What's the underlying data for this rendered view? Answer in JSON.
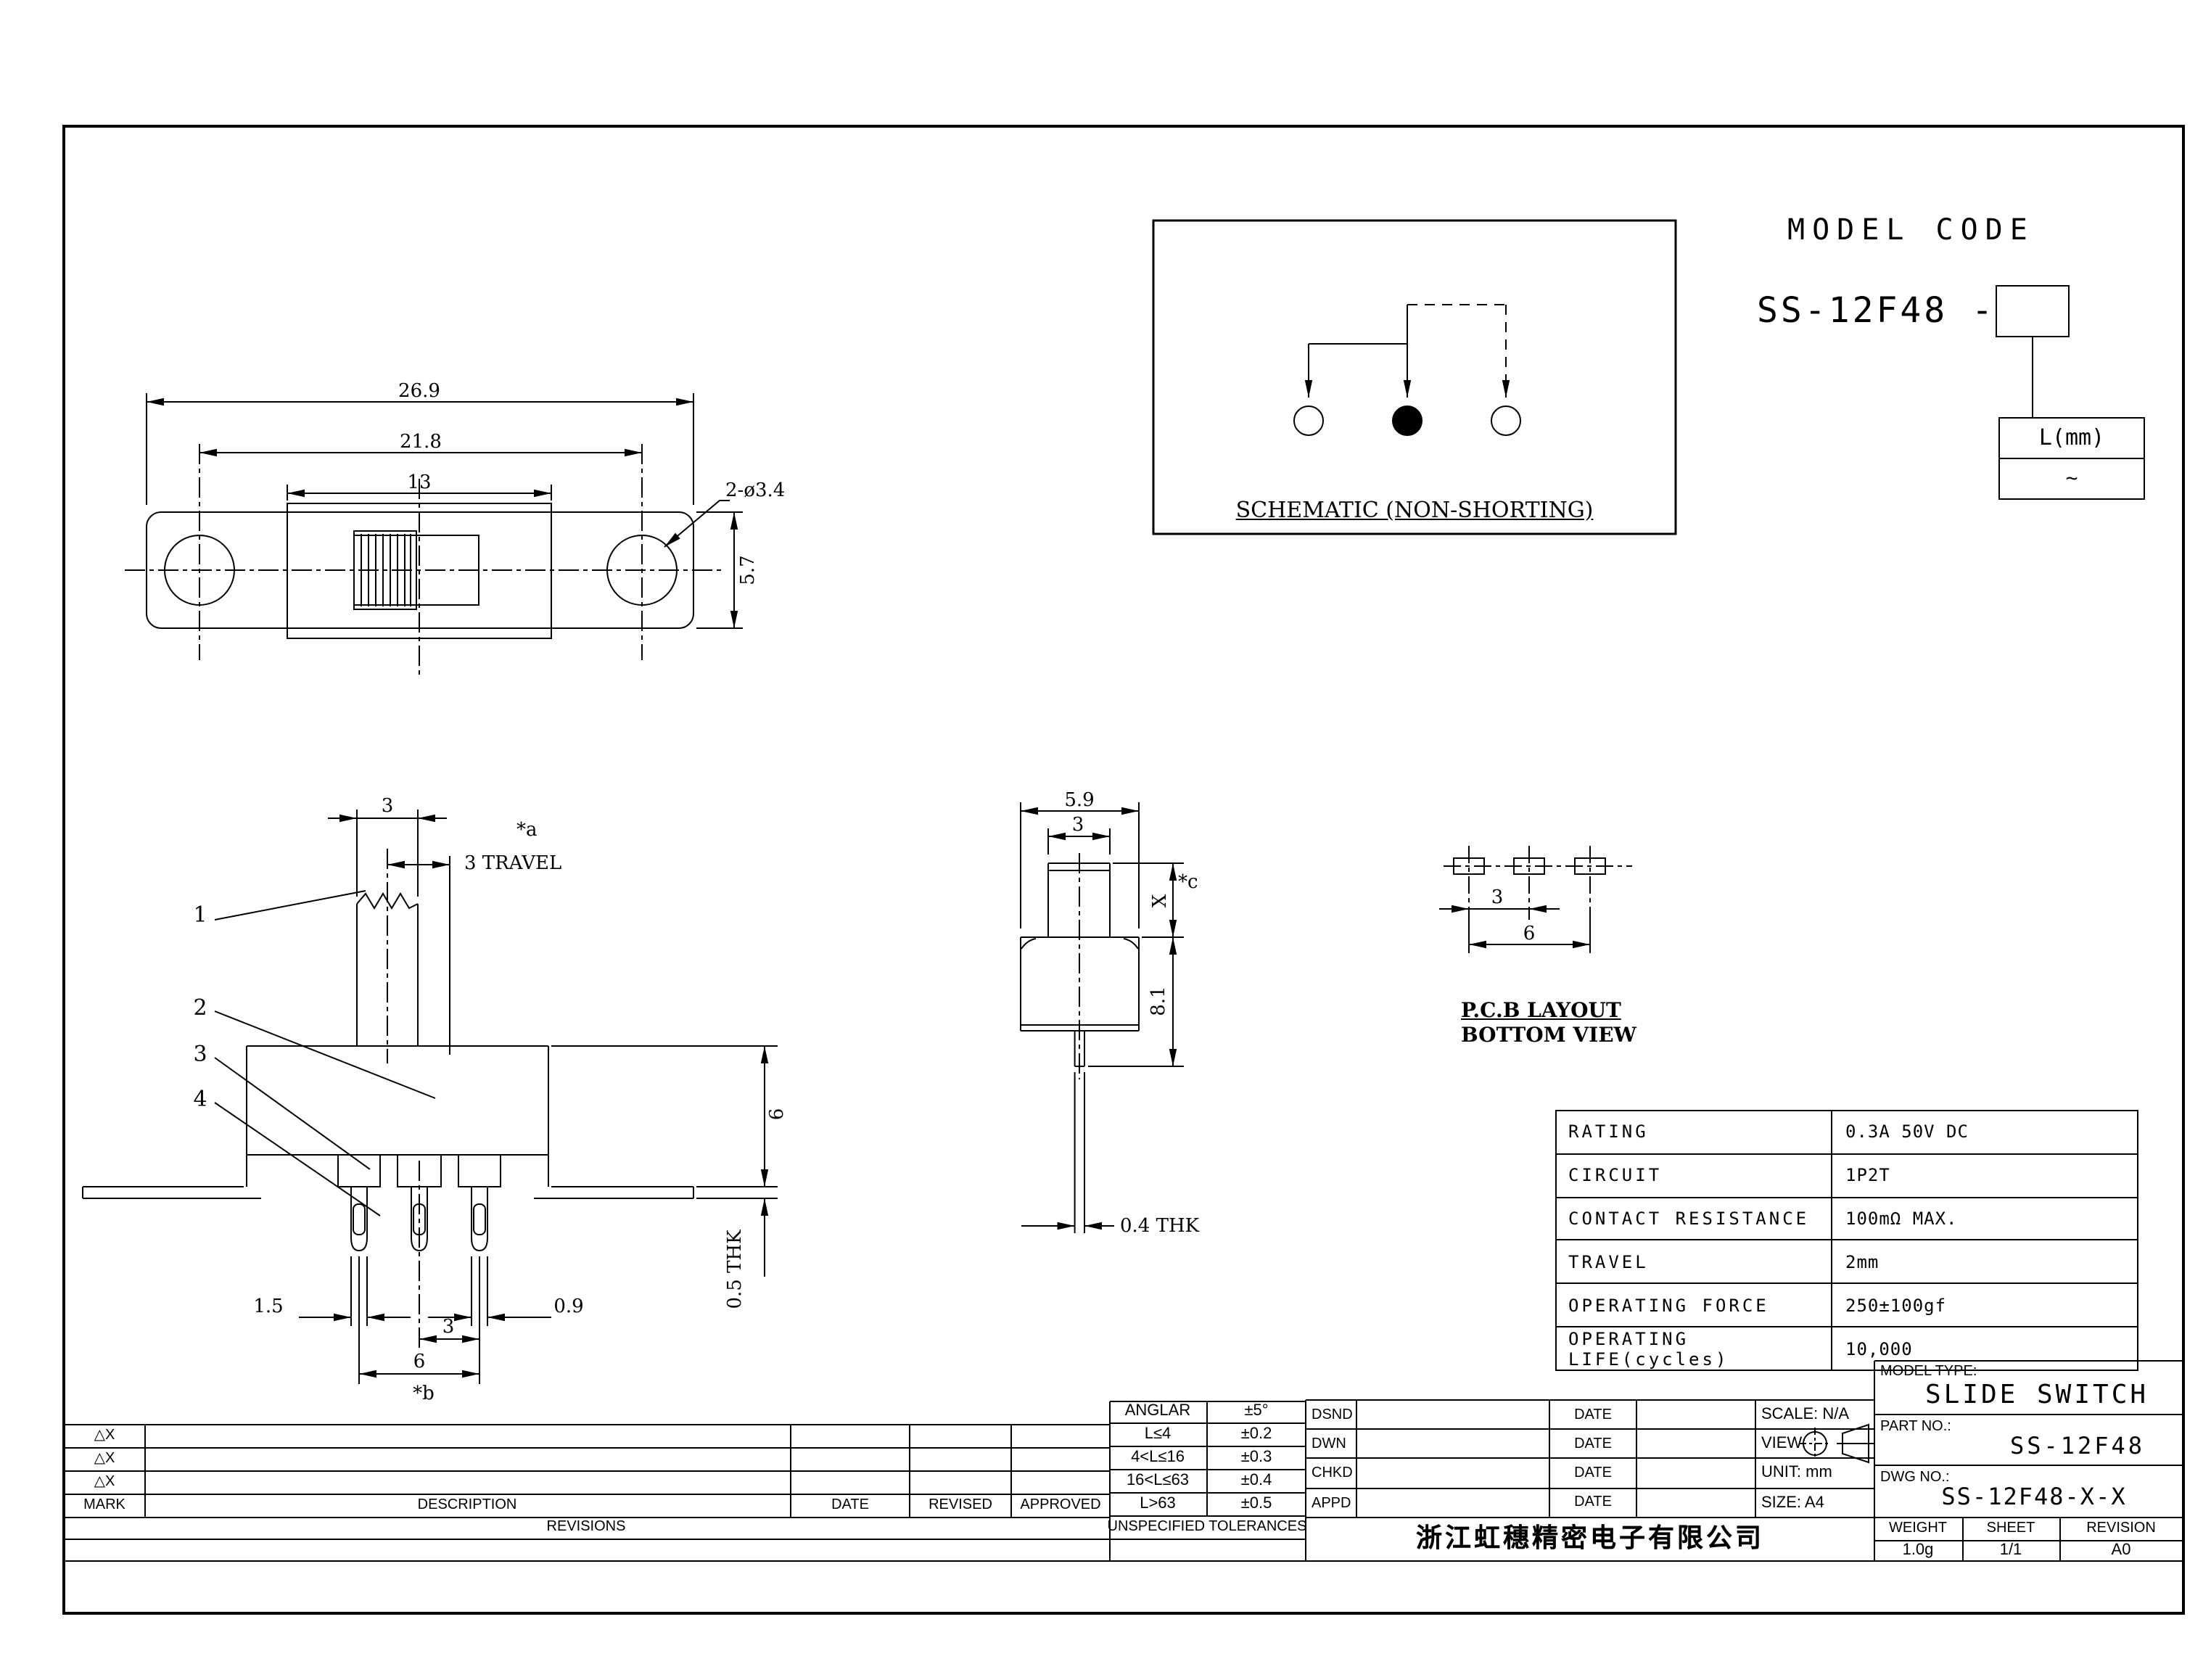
{
  "drawing": {
    "model_code": {
      "title": "MODEL CODE",
      "prefix": "SS-12F48 -",
      "suffix_header": "L(mm)",
      "suffix_value": "~"
    },
    "schematic": {
      "caption": "SCHEMATIC (NON-SHORTING)"
    },
    "plan_view": {
      "dim_overall": "26.9",
      "dim_hole_span": "21.8",
      "dim_frame": "13",
      "dim_holes": "2-ø3.4",
      "dim_height": "5.7"
    },
    "front_view": {
      "dim_knob": "3",
      "note_a": "*a",
      "dim_travel": "3 TRAVEL",
      "leader_1": "1",
      "leader_2": "2",
      "leader_3": "3",
      "leader_4": "4",
      "dim_body_height": "6",
      "dim_bracket_thk": "0.5 THK",
      "dim_pin_left": "1.5",
      "dim_pin_width": "0.9",
      "dim_pin_pitch": "3",
      "dim_pin_span": "6",
      "note_b": "*b"
    },
    "side_view": {
      "dim_width": "5.9",
      "dim_knob": "3",
      "dim_knob_height": "X",
      "note_c": "*c",
      "dim_body": "8.1",
      "dim_pin_thk": "0.4 THK"
    },
    "pcb_layout": {
      "title": "P.C.B LAYOUT",
      "subtitle": "BOTTOM VIEW",
      "dim_pitch": "3",
      "dim_span": "6"
    }
  },
  "specs": {
    "rows": [
      {
        "label": "RATING",
        "value": "0.3A 50V DC"
      },
      {
        "label": "CIRCUIT",
        "value": "1P2T"
      },
      {
        "label": "CONTACT RESISTANCE",
        "value": "100mΩ MAX."
      },
      {
        "label": "TRAVEL",
        "value": "2mm"
      },
      {
        "label": "OPERATING FORCE",
        "value": "250±100gf"
      },
      {
        "label": "OPERATING LIFE(cycles)",
        "value": "10,000"
      }
    ]
  },
  "revisions": {
    "marks": [
      "△X",
      "△X",
      "△X"
    ],
    "headers": {
      "mark": "MARK",
      "description": "DESCRIPTION",
      "date": "DATE",
      "revised": "REVISED",
      "approved": "APPROVED"
    },
    "footer": "REVISIONS"
  },
  "tolerances": {
    "rows": [
      {
        "range": "ANGLAR",
        "tol": "±5°"
      },
      {
        "range": "L≤4",
        "tol": "±0.2"
      },
      {
        "range": "4<L≤16",
        "tol": "±0.3"
      },
      {
        "range": "16<L≤63",
        "tol": "±0.4"
      },
      {
        "range": "L>63",
        "tol": "±0.5"
      }
    ],
    "footer": "UNSPECIFIED TOLERANCES"
  },
  "title_block": {
    "rows": [
      {
        "role": "DSND",
        "date": "DATE",
        "info": "SCALE: N/A"
      },
      {
        "role": "DWN",
        "date": "DATE",
        "info": "VIEW:"
      },
      {
        "role": "CHKD",
        "date": "DATE",
        "info": "UNIT: mm"
      },
      {
        "role": "APPD",
        "date": "DATE",
        "info": "SIZE: A4"
      }
    ],
    "company": "浙江虹穗精密电子有限公司"
  },
  "part_info": {
    "model_type_label": "MODEL TYPE:",
    "model_type": "SLIDE SWITCH",
    "part_no_label": "PART NO.:",
    "part_no": "SS-12F48",
    "dwg_no_label": "DWG NO.:",
    "dwg_no": "SS-12F48-X-X",
    "weight_label": "WEIGHT",
    "weight": "1.0g",
    "sheet_label": "SHEET",
    "sheet": "1/1",
    "revision_label": "REVISION",
    "revision": "A0"
  }
}
